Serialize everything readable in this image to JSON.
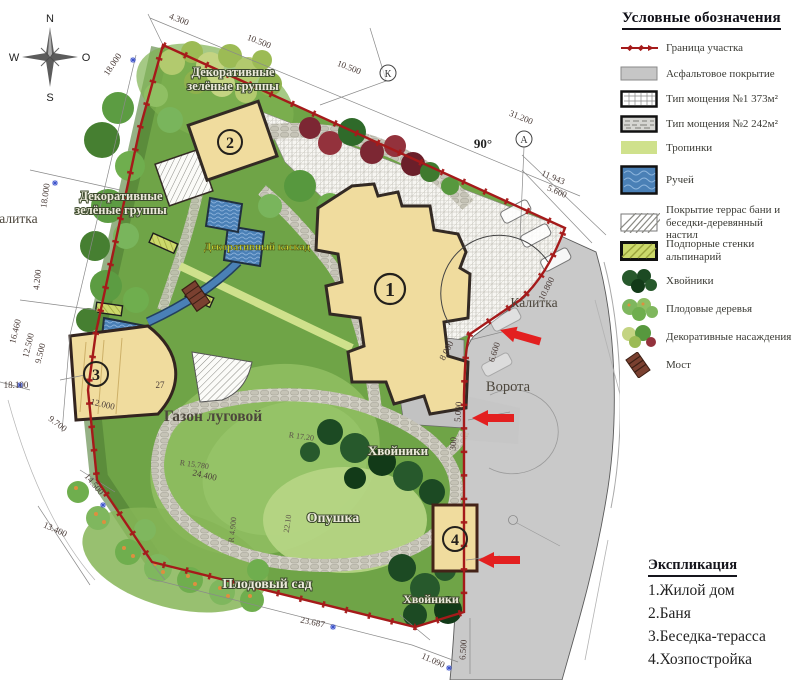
{
  "legend": {
    "title": "Условные обозначения",
    "items": [
      {
        "icon": "boundary-line-icon",
        "label": "Граница участка"
      },
      {
        "icon": "asphalt-icon",
        "label": "Асфальтовое покрытие"
      },
      {
        "icon": "paving-type1-icon",
        "label": "Тип мощения №1 373м²"
      },
      {
        "icon": "paving-type2-icon",
        "label": "Тип мощения №2 242м²"
      },
      {
        "icon": "footpath-icon",
        "label": "Тропинки"
      },
      {
        "icon": "stream-icon",
        "label": "Ручей"
      },
      {
        "icon": "deck-icon",
        "label": "Покрытие террас бани и беседки-деревянный настил"
      },
      {
        "icon": "retaining-wall-icon",
        "label": "Подпорные стенки альпинарий"
      },
      {
        "icon": "conifer-icon",
        "label": "Хвойники"
      },
      {
        "icon": "fruit-tree-icon",
        "label": "Плодовые деревья"
      },
      {
        "icon": "ornamental-icon",
        "label": "Декоративные насаждения"
      },
      {
        "icon": "bridge-icon",
        "label": "Мост"
      }
    ]
  },
  "explication": {
    "title": "Экспликация",
    "items": [
      "1.Жилой дом",
      "2.Баня",
      "3.Беседка-терасса",
      "4.Хозпостройка"
    ]
  },
  "compass": {
    "north": "N",
    "south": "S",
    "west": "W",
    "east": "O"
  },
  "labels": {
    "deco_top_1": "Декоративные",
    "deco_top_2": "зелёные группы",
    "deco_left_1": "Декоративные",
    "deco_left_2": "зелёные группы",
    "gate_left": "Калитка",
    "cascade": "Декоративный каскад",
    "lawn": "Газон луговой",
    "conifers_mid": "Хвойники",
    "glade": "Опушка",
    "orchard": "Плодовый сад",
    "conifers_bottom": "Хвойники",
    "gate_right": "Калитка",
    "main_gate": "Ворота",
    "angle": "90°",
    "marker_k": "К",
    "marker_a": "А"
  },
  "buildings": {
    "house": "1",
    "bathhouse": "2",
    "gazebo": "3",
    "shed": "4"
  },
  "dims": [
    "4.300",
    "10.500",
    "10.500",
    "31.200",
    "11.943",
    "5.600",
    "18.000",
    "18.000",
    "4.200",
    "16.460",
    "12.500",
    "9.500",
    "18.100",
    "9.700",
    "14.500",
    "13.400",
    "23.687",
    "11.090",
    "6.500",
    "5.000",
    "300",
    "8.000",
    "6.600",
    "10.800",
    "12.000",
    "27",
    "24.400",
    "R 17.20",
    "R 15.780",
    "R 4.900",
    "22.10"
  ],
  "colors": {
    "boundary": "#a51a1a",
    "entrance_arrow": "#e32020",
    "building_fill": "#f0dc9e",
    "water": "#4a80b6",
    "road": "#c9c9c9",
    "footpath": "#cfe18c",
    "plot_green": "#6fa447",
    "retaining_wall": "#ccd96b"
  }
}
